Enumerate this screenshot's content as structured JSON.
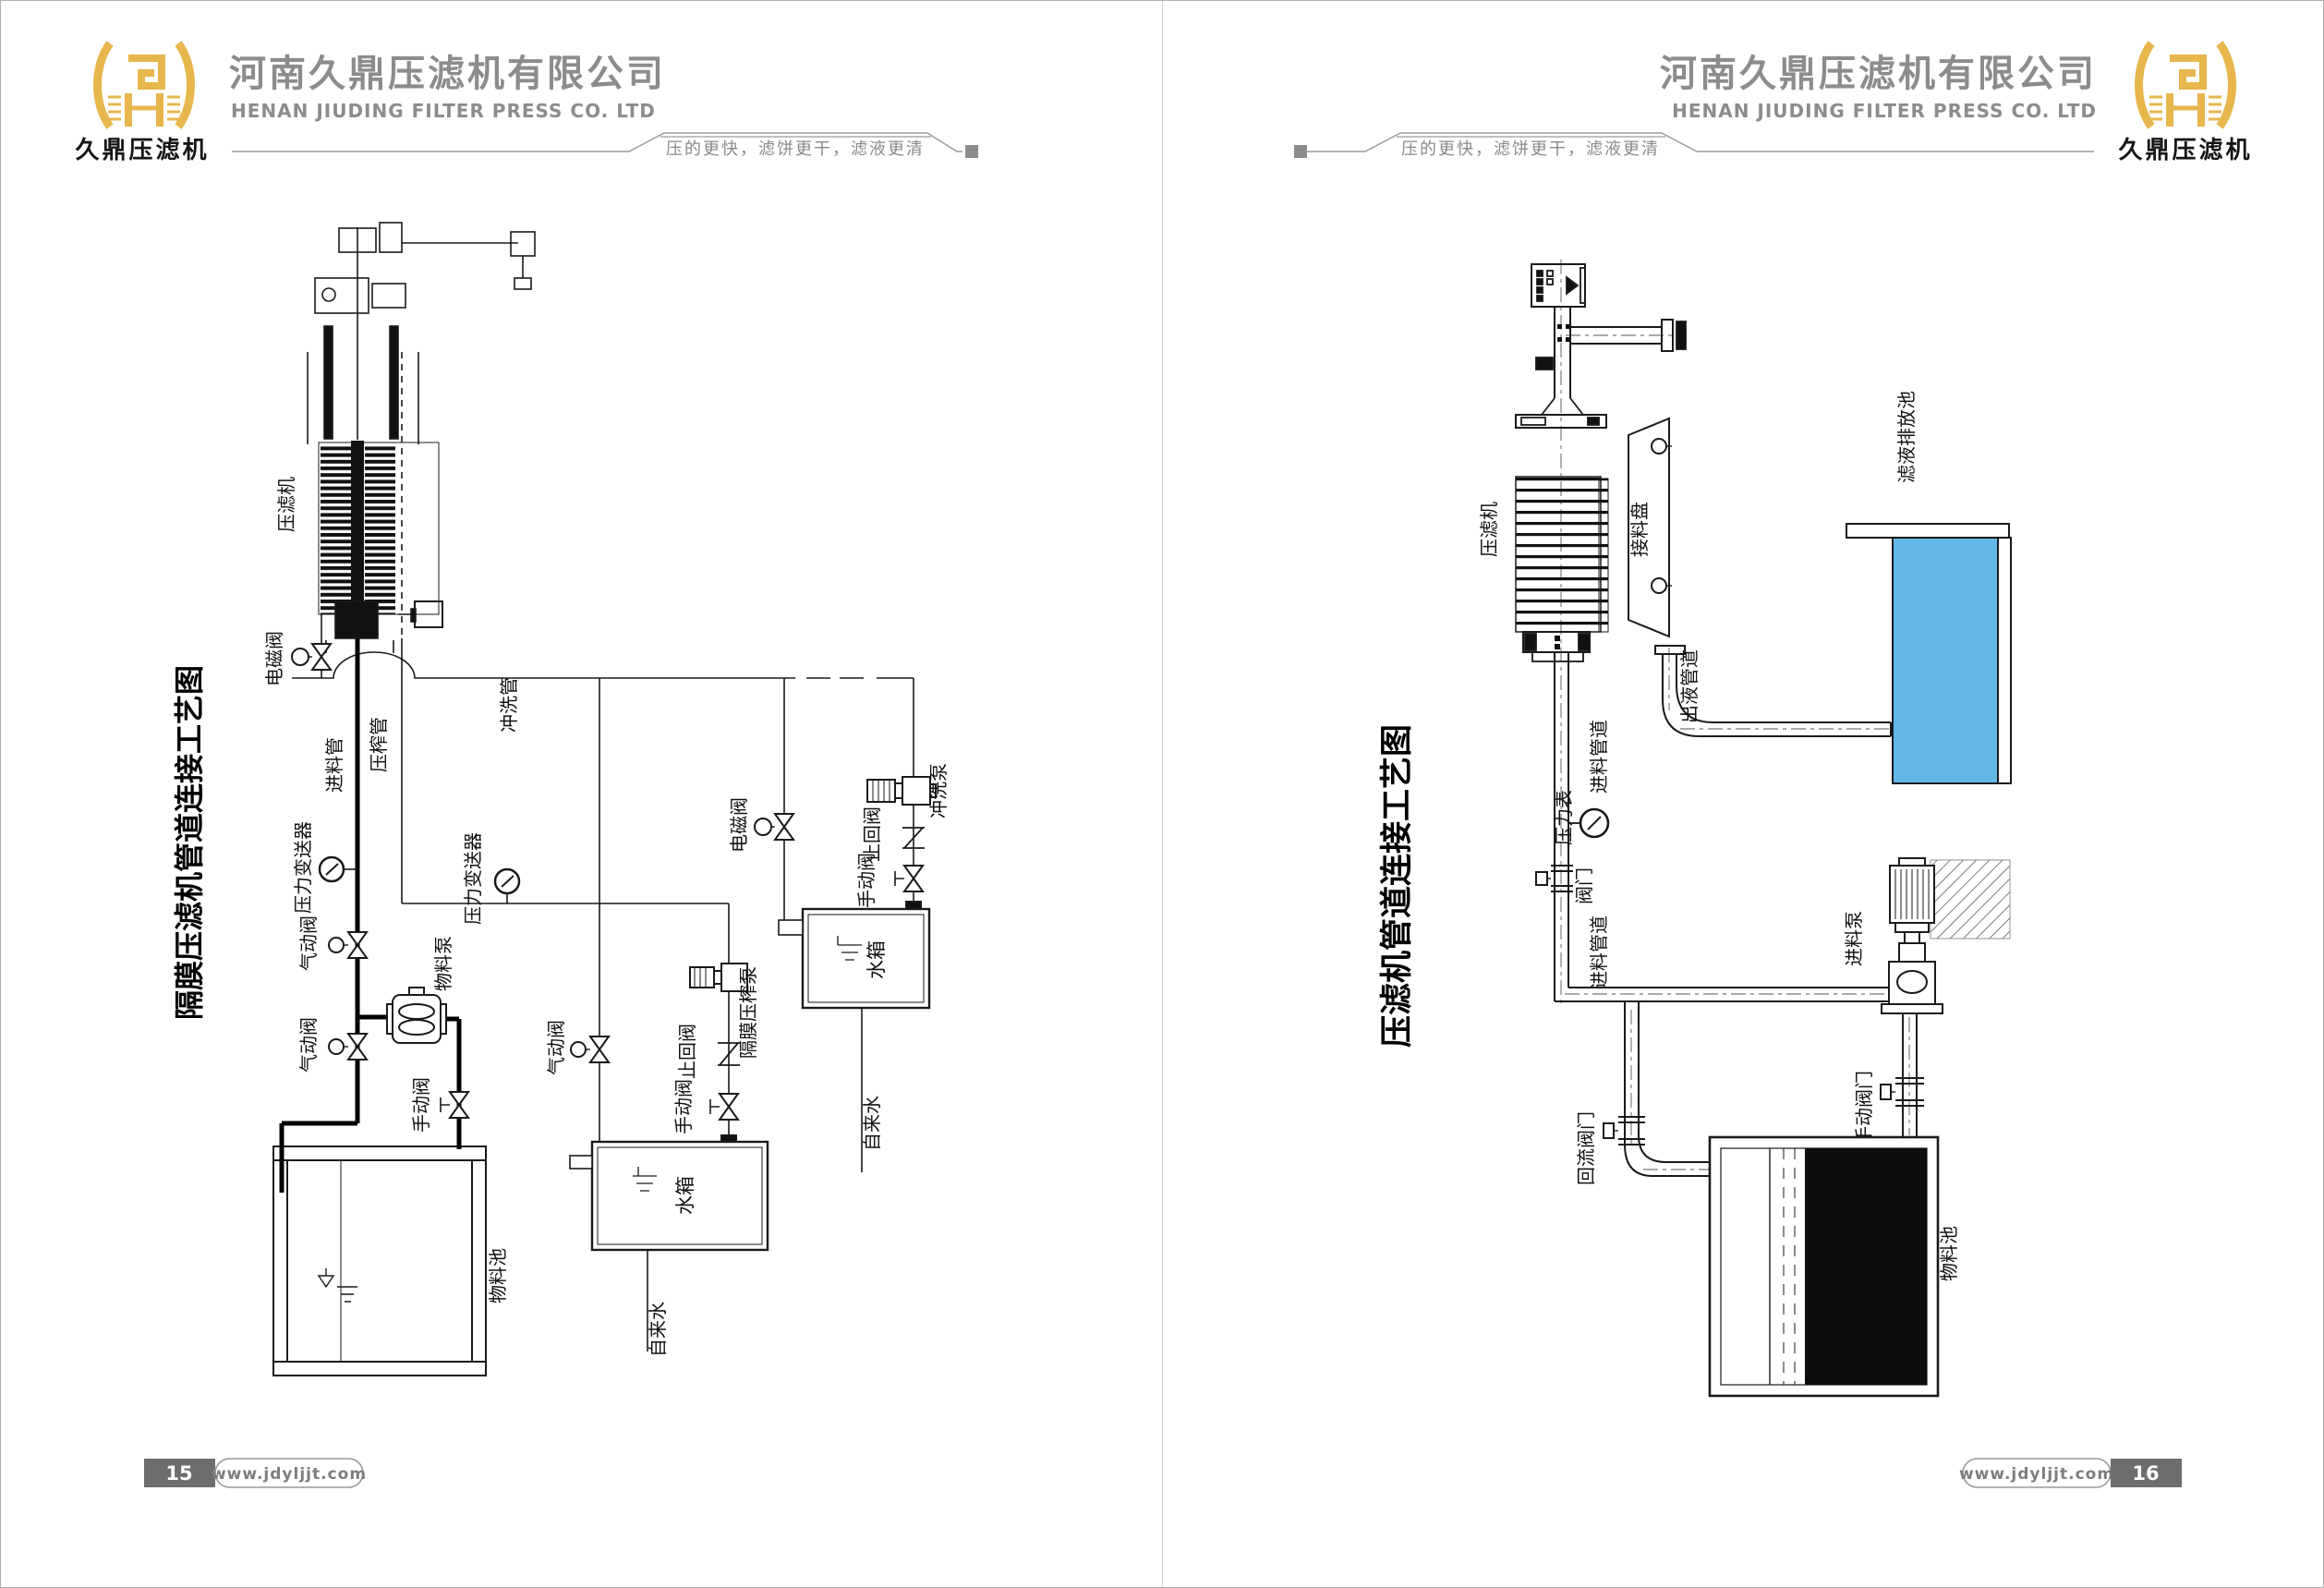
{
  "brand": {
    "company_cn": "河南久鼎压滤机有限公司",
    "company_en": "HENAN JIUDING FILTER PRESS CO. LTD",
    "logo_caption": "久鼎压滤机",
    "tagline": "压的更快，滤饼更干，滤液更清",
    "website": "www.jdyljjt.com"
  },
  "colors": {
    "logo_gold": "#e7b64d",
    "header_gray": "#8c8c8c",
    "diagram_line": "#1a1a1a",
    "pool_blue": "#63b7e6",
    "slurry_black": "#0d0d0d",
    "footer_box_gray": "#6d6d6d"
  },
  "page_left": {
    "page_number": "15",
    "title": "隔膜压滤机管道连接工艺图",
    "labels": {
      "machine": "压滤机",
      "solenoid_valve_1": "电磁阀",
      "feed_pipe": "进料管",
      "squeeze_pipe": "压榨管",
      "flush_pipe": "冲洗管",
      "pressure_transmitter_1": "压力变送器",
      "pressure_transmitter_2": "压力变送器",
      "pneumatic_valve_1": "气动阀",
      "pneumatic_valve_2": "气动阀",
      "pneumatic_valve_3": "气动阀",
      "material_pump": "物料泵",
      "manual_valve_1": "手动阀",
      "solenoid_valve_2": "电磁阀",
      "check_valve_1": "止回阀",
      "manual_valve_2": "手动阀",
      "flush_pump": "冲洗泵",
      "water_tank_1": "水箱",
      "diaphragm_squeeze_pump": "隔膜压榨泵",
      "check_valve_2": "止回阀",
      "manual_valve_3": "手动阀",
      "water_tank_2": "水箱",
      "tap_water_1": "自来水",
      "tap_water_2": "自来水",
      "material_pool": "物料池"
    }
  },
  "page_right": {
    "page_number": "16",
    "title": "压滤机管道连接工艺图",
    "labels": {
      "machine": "压滤机",
      "receiving_tray": "接料盘",
      "filtrate_discharge_pool": "滤液排放池",
      "outlet_pipe": "出液管道",
      "feed_pipe_1": "进料管道",
      "pressure_gauge": "压力表",
      "valve": "阀门",
      "feed_pipe_2": "进料管道",
      "feed_pump": "进料泵",
      "manual_valve": "手动阀门",
      "return_valve": "回流阀门",
      "material_pool": "物料池"
    }
  }
}
